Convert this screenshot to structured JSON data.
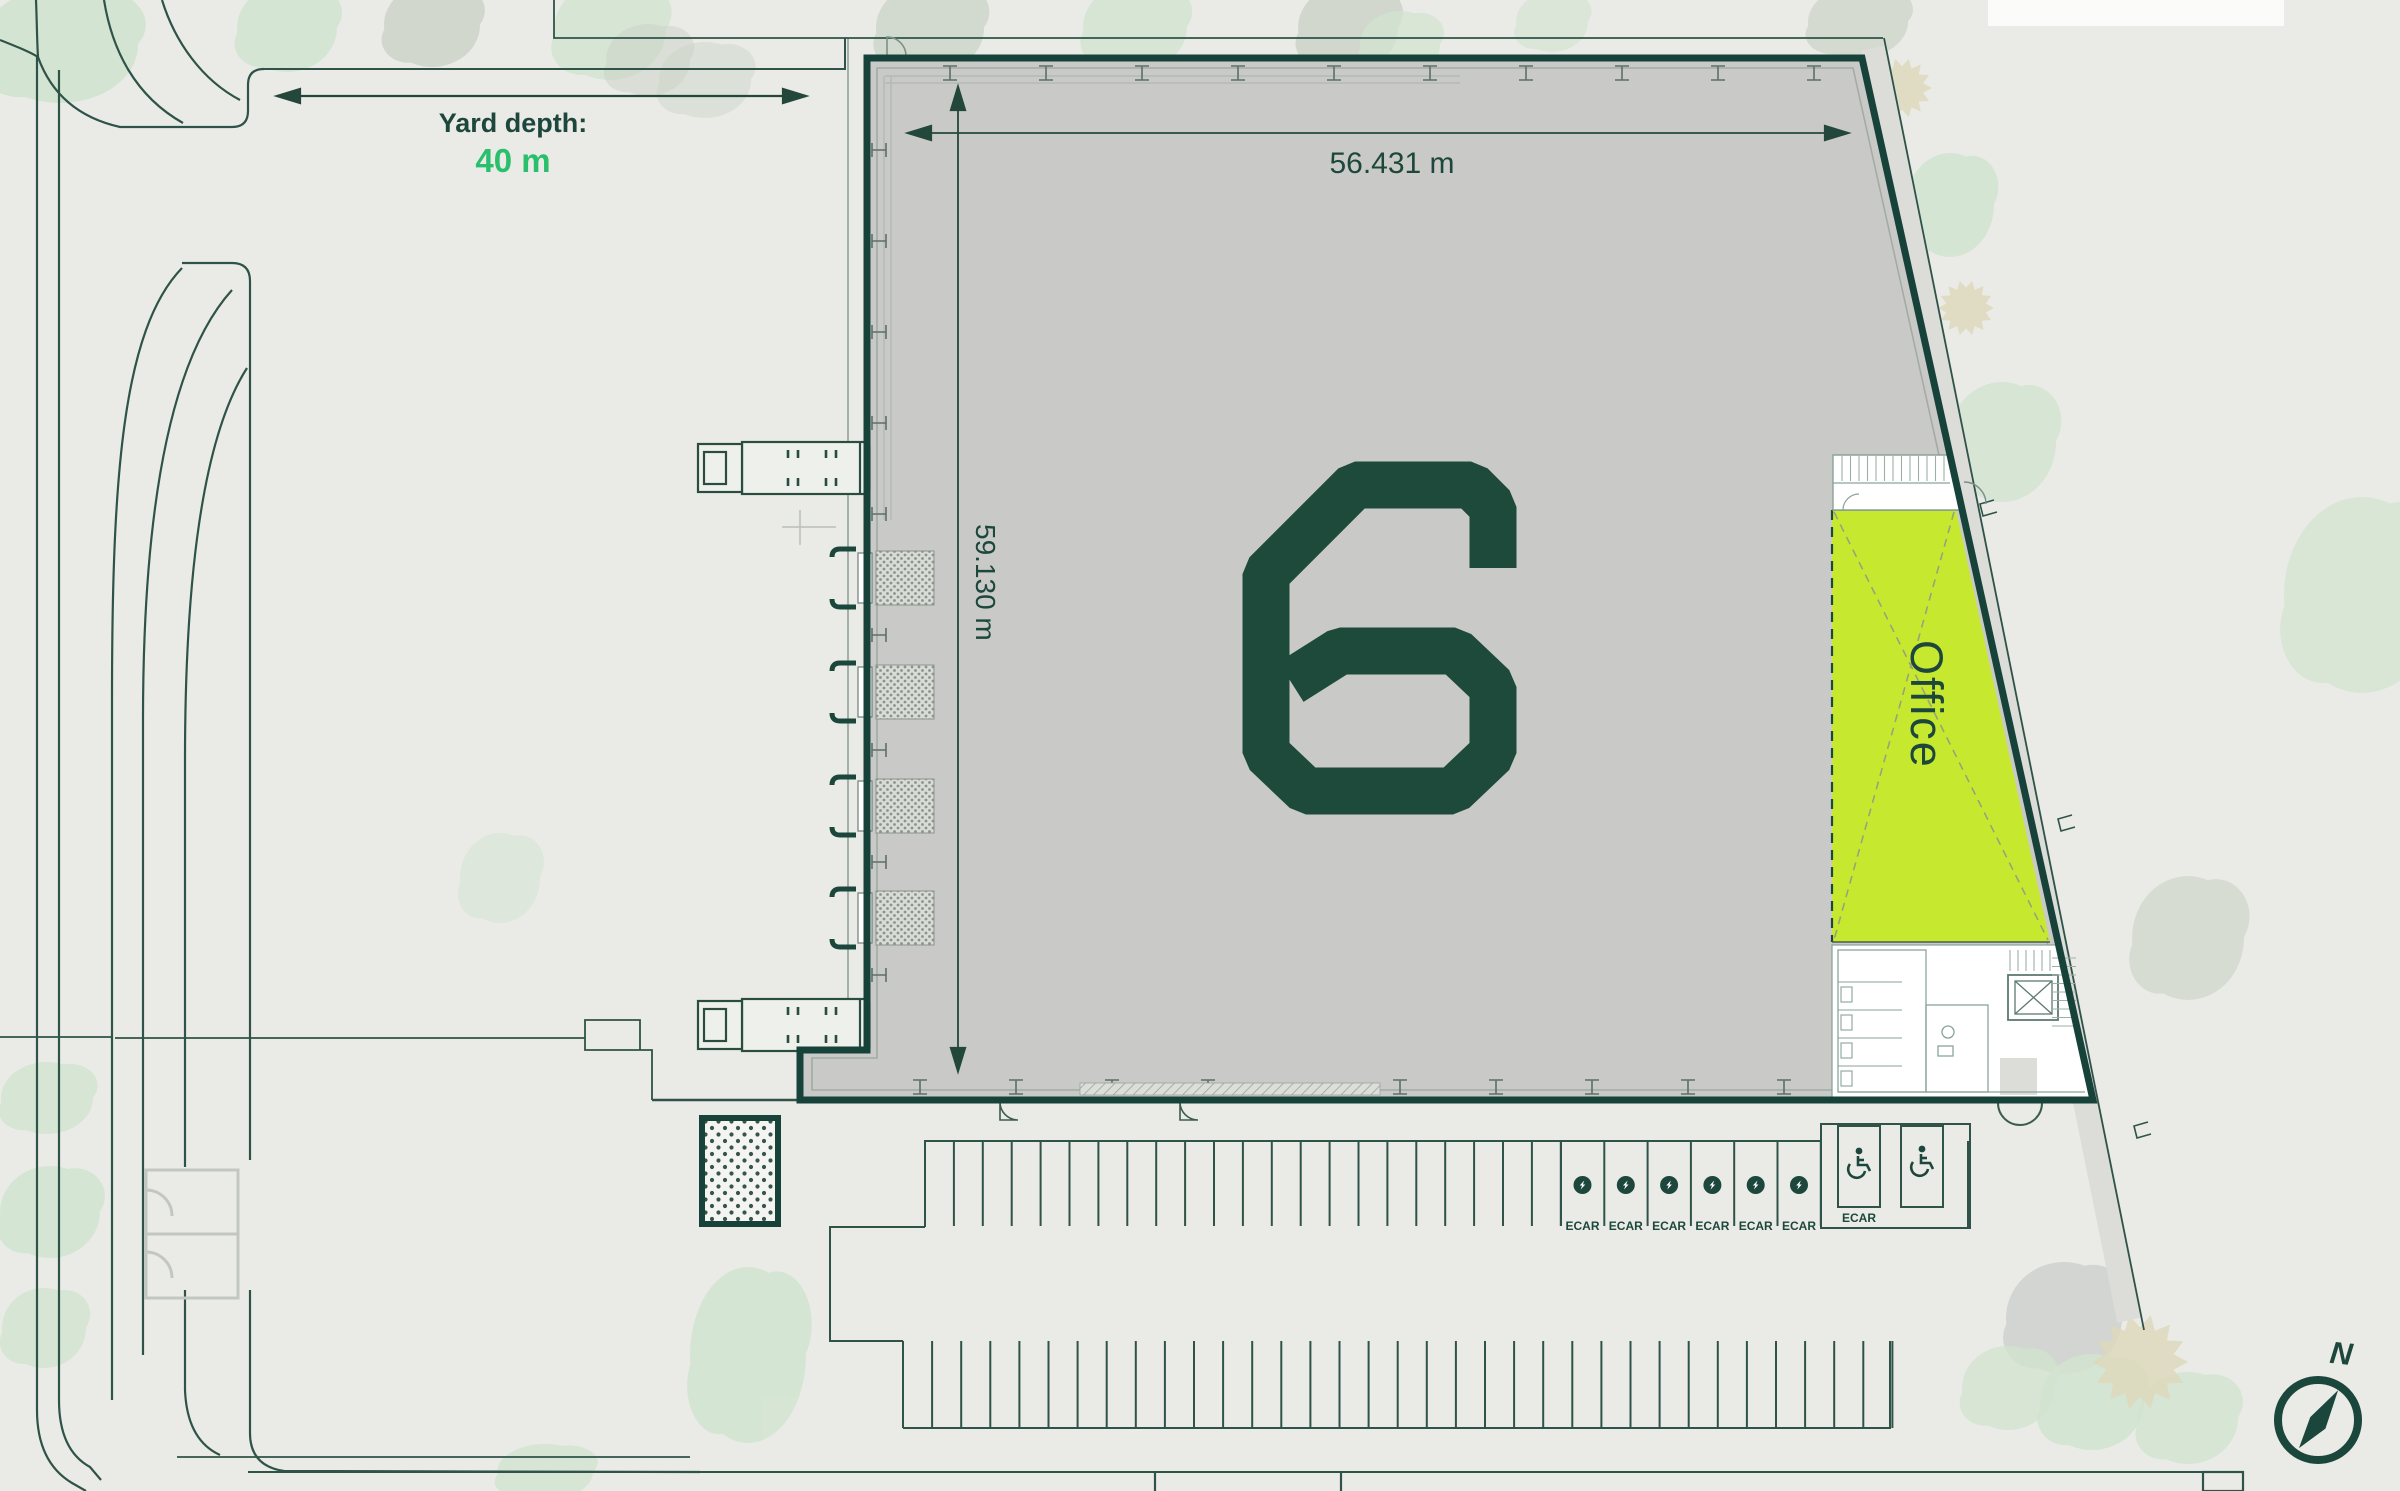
{
  "labels": {
    "yard_depth_label": "Yard depth:",
    "yard_depth_value": "40 m",
    "building_width": "56.431 m",
    "building_height": "59.130 m",
    "office": "Office",
    "building_number": "6",
    "north": "N"
  },
  "parking": {
    "ecar_label": "ECAR",
    "ecar_count": 6,
    "accessible_ecar_label": "ECAR",
    "accessible_spot_count": 2
  },
  "icons": {
    "lightning-icon": "EV charging bolt in filled circle",
    "wheelchair-icon": "accessible parking symbol",
    "compass-icon": "circle with needle pointing north-east",
    "north-arrow-label": "N"
  },
  "colors": {
    "background": "#eaebe7",
    "building_gray": "#c9cac7",
    "wall_dark_green": "#16423a",
    "accent_dark": "#1d473c",
    "accent_green": "#2abf6c",
    "office_lime": "#c6e930"
  }
}
